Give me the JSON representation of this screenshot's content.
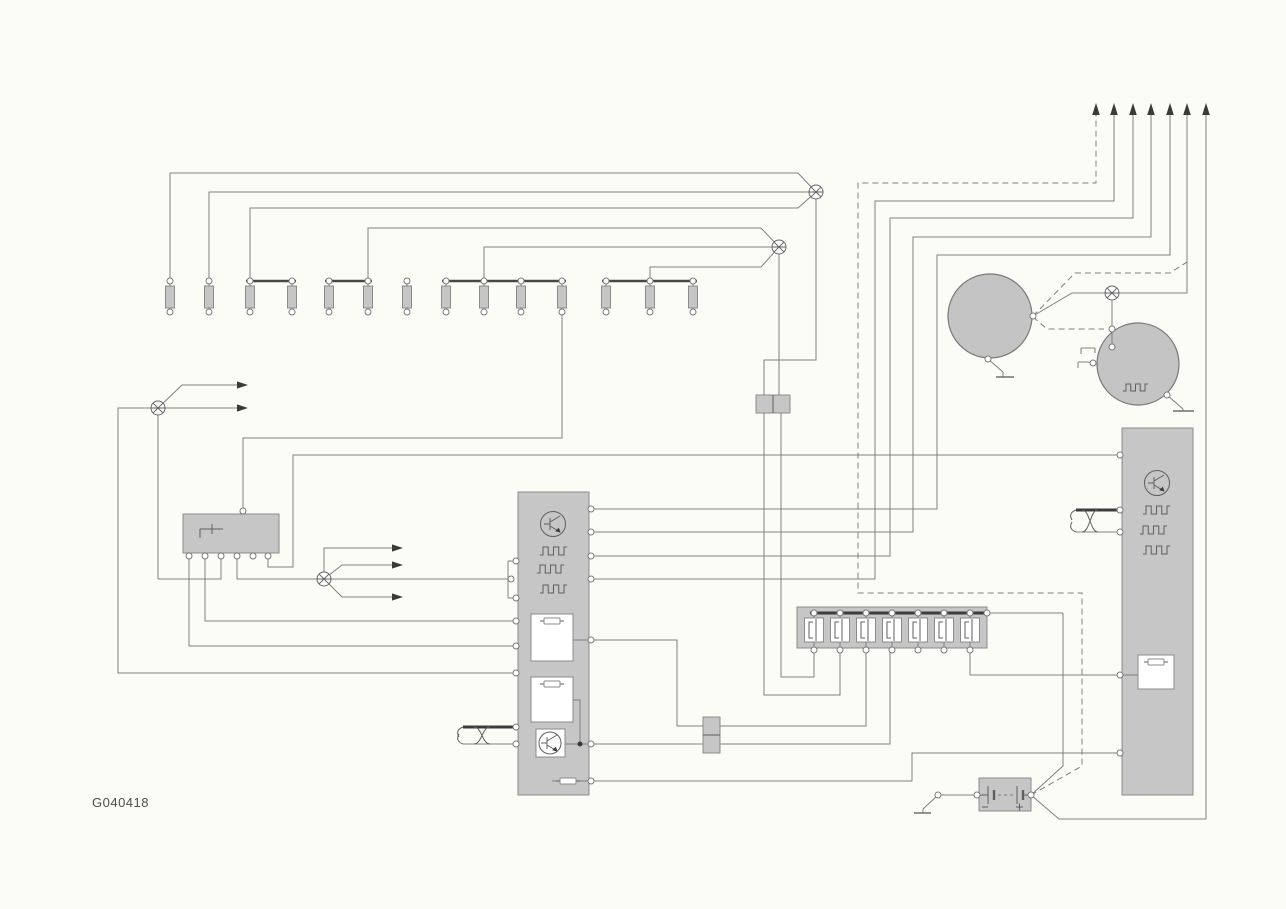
{
  "label": {
    "text": "G040418"
  },
  "canvas": {
    "w": 1286,
    "h": 909
  },
  "colors": {
    "background": "#fcfcf7",
    "wire": "#7f7f7f",
    "component_fill": "#c6c6c6",
    "component_stroke": "#8b8b8b",
    "dark": "#3c3c3c"
  },
  "boxes": [
    {
      "name": "control-unit-box",
      "x": 518,
      "y": 492,
      "w": 71,
      "h": 303
    },
    {
      "name": "relay-box",
      "x": 183,
      "y": 514,
      "w": 96,
      "h": 39
    },
    {
      "name": "right-module-box",
      "x": 1122,
      "y": 428,
      "w": 71,
      "h": 367
    },
    {
      "name": "fuse-strip-box",
      "x": 797,
      "y": 607,
      "w": 190,
      "h": 41
    },
    {
      "name": "connector-double-top",
      "x": 756,
      "y": 395,
      "w": 34,
      "h": 18
    },
    {
      "name": "connector-double-mid",
      "x": 703,
      "y": 717,
      "w": 17,
      "h": 36
    },
    {
      "name": "battery-box",
      "x": 979,
      "y": 778,
      "w": 52,
      "h": 33
    }
  ],
  "dividers": [
    [
      773,
      395,
      773,
      413
    ],
    [
      703,
      735,
      720,
      735
    ]
  ],
  "white_boxes": [
    {
      "name": "driver-box-1",
      "x": 531,
      "y": 614,
      "w": 42,
      "h": 47
    },
    {
      "name": "driver-box-2",
      "x": 531,
      "y": 677,
      "w": 42,
      "h": 45
    },
    {
      "name": "transistor-box",
      "x": 536,
      "y": 729,
      "w": 29,
      "h": 28
    },
    {
      "name": "module-driver-box",
      "x": 1138,
      "y": 655,
      "w": 36,
      "h": 34
    }
  ],
  "big_circles": [
    {
      "name": "generator-circle",
      "cx": 990,
      "cy": 316,
      "r": 42
    },
    {
      "name": "alternator-circle",
      "cx": 1138,
      "cy": 364,
      "r": 41
    }
  ],
  "injectors": {
    "xs": [
      170,
      209,
      250,
      292,
      329,
      368,
      407,
      446,
      484,
      521,
      562,
      606,
      650,
      693
    ],
    "top_y": 281,
    "bot_y": 312,
    "body_y": 286,
    "body_h": 22,
    "body_w": 9,
    "bars": [
      [
        246,
        281,
        296
      ],
      [
        325,
        281,
        372
      ],
      [
        442,
        281,
        566
      ],
      [
        602,
        281,
        697
      ]
    ]
  },
  "fuse_strip": {
    "centers": [
      814,
      840,
      866,
      892,
      918,
      944,
      970
    ],
    "box_y": 618,
    "box_h": 24,
    "top_y": 613,
    "bot_y": 650,
    "bus": [
      810,
      613,
      984
    ]
  },
  "wires_solid": [
    [
      [
        170,
        281
      ],
      [
        170,
        173
      ],
      [
        798,
        173
      ],
      [
        816,
        192
      ]
    ],
    [
      [
        209,
        281
      ],
      [
        209,
        192
      ],
      [
        816,
        192
      ]
    ],
    [
      [
        250,
        281
      ],
      [
        250,
        208
      ],
      [
        798,
        208
      ],
      [
        816,
        192
      ]
    ],
    [
      [
        368,
        281
      ],
      [
        368,
        228
      ],
      [
        761,
        228
      ],
      [
        779,
        247
      ]
    ],
    [
      [
        484,
        281
      ],
      [
        484,
        247
      ],
      [
        779,
        247
      ]
    ],
    [
      [
        650,
        281
      ],
      [
        650,
        267
      ],
      [
        761,
        267
      ],
      [
        779,
        247
      ]
    ],
    [
      [
        816,
        192
      ],
      [
        816,
        360
      ],
      [
        764,
        360
      ],
      [
        764,
        395
      ]
    ],
    [
      [
        779,
        247
      ],
      [
        779,
        395
      ]
    ],
    [
      [
        764,
        413
      ],
      [
        764,
        695
      ],
      [
        840,
        695
      ],
      [
        840,
        650
      ]
    ],
    [
      [
        781,
        413
      ],
      [
        781,
        677
      ],
      [
        814,
        677
      ],
      [
        814,
        650
      ]
    ],
    [
      [
        562,
        312
      ],
      [
        562,
        438
      ],
      [
        243,
        438
      ],
      [
        243,
        511
      ]
    ],
    [
      [
        268,
        556
      ],
      [
        268,
        567
      ],
      [
        293,
        567
      ],
      [
        293,
        455
      ],
      [
        1117,
        455
      ]
    ],
    [
      [
        237,
        556
      ],
      [
        237,
        579
      ],
      [
        508,
        579
      ]
    ],
    [
      [
        221,
        556
      ],
      [
        221,
        579
      ],
      [
        158,
        579
      ]
    ],
    [
      [
        158,
        408
      ],
      [
        158,
        579
      ]
    ],
    [
      [
        158,
        408
      ],
      [
        118,
        408
      ],
      [
        118,
        673
      ],
      [
        514,
        673
      ]
    ],
    [
      [
        189,
        556
      ],
      [
        189,
        646
      ],
      [
        514,
        646
      ]
    ],
    [
      [
        205,
        556
      ],
      [
        205,
        621
      ],
      [
        514,
        621
      ]
    ],
    [
      [
        158,
        408
      ],
      [
        182,
        385
      ],
      [
        242,
        385
      ]
    ],
    [
      [
        158,
        408
      ],
      [
        242,
        408
      ]
    ],
    [
      [
        324,
        579
      ],
      [
        324,
        548
      ],
      [
        397,
        548
      ]
    ],
    [
      [
        324,
        579
      ],
      [
        342,
        565
      ],
      [
        397,
        565
      ]
    ],
    [
      [
        324,
        579
      ],
      [
        342,
        597
      ],
      [
        397,
        597
      ]
    ],
    [
      [
        508,
        561
      ],
      [
        515,
        561
      ]
    ],
    [
      [
        508,
        598
      ],
      [
        515,
        598
      ]
    ],
    [
      [
        508,
        561
      ],
      [
        508,
        598
      ]
    ],
    [
      [
        592,
        509
      ],
      [
        937,
        509
      ],
      [
        937,
        255
      ],
      [
        1170,
        255
      ],
      [
        1170,
        114
      ]
    ],
    [
      [
        592,
        532
      ],
      [
        913,
        532
      ],
      [
        913,
        237
      ],
      [
        1151,
        237
      ],
      [
        1151,
        114
      ]
    ],
    [
      [
        592,
        556
      ],
      [
        890,
        556
      ],
      [
        890,
        218
      ],
      [
        1133,
        218
      ],
      [
        1133,
        114
      ]
    ],
    [
      [
        592,
        579
      ],
      [
        875,
        579
      ],
      [
        875,
        201
      ],
      [
        1114,
        201
      ],
      [
        1114,
        114
      ]
    ],
    [
      [
        573,
        640
      ],
      [
        591,
        640
      ]
    ],
    [
      [
        592,
        640
      ],
      [
        677,
        640
      ],
      [
        677,
        726
      ],
      [
        703,
        726
      ]
    ],
    [
      [
        720,
        726
      ],
      [
        866,
        726
      ],
      [
        866,
        650
      ]
    ],
    [
      [
        565,
        744
      ],
      [
        703,
        744
      ]
    ],
    [
      [
        573,
        700
      ],
      [
        580,
        700
      ],
      [
        580,
        744
      ]
    ],
    [
      [
        720,
        744
      ],
      [
        890,
        744
      ],
      [
        890,
        650
      ]
    ],
    [
      [
        552,
        781
      ],
      [
        592,
        781
      ]
    ],
    [
      [
        592,
        781
      ],
      [
        912,
        781
      ],
      [
        912,
        753
      ],
      [
        1117,
        753
      ]
    ],
    [
      [
        970,
        650
      ],
      [
        970,
        675
      ],
      [
        1117,
        675
      ]
    ],
    [
      [
        987,
        613
      ],
      [
        1063,
        613
      ]
    ],
    [
      [
        1031,
        795
      ],
      [
        1063,
        766
      ],
      [
        1063,
        613
      ]
    ],
    [
      [
        1031,
        795
      ],
      [
        1059,
        819
      ],
      [
        1206,
        819
      ],
      [
        1206,
        114
      ]
    ],
    [
      [
        977,
        795
      ],
      [
        941,
        795
      ]
    ],
    [
      [
        936,
        797
      ],
      [
        923,
        809
      ]
    ],
    [
      [
        923,
        809
      ],
      [
        923,
        813
      ]
    ],
    [
      [
        1033,
        316
      ],
      [
        1072,
        293
      ],
      [
        1187,
        293
      ],
      [
        1187,
        114
      ]
    ],
    [
      [
        1112,
        293
      ],
      [
        1112,
        347
      ]
    ],
    [
      [
        988,
        359
      ],
      [
        1003,
        372
      ]
    ],
    [
      [
        1003,
        372
      ],
      [
        1003,
        377
      ]
    ],
    [
      [
        1167,
        395
      ],
      [
        1183,
        409
      ]
    ],
    [
      [
        1183,
        409
      ],
      [
        1183,
        411
      ]
    ],
    [
      [
        1093,
        363
      ],
      [
        1088,
        362
      ]
    ],
    [
      [
        1081,
        348
      ],
      [
        1095,
        348
      ]
    ],
    [
      [
        1095,
        348
      ],
      [
        1095,
        353
      ]
    ],
    [
      [
        1081,
        348
      ],
      [
        1081,
        354
      ]
    ],
    [
      [
        1078,
        362
      ],
      [
        1088,
        362
      ]
    ],
    [
      [
        1078,
        362
      ],
      [
        1078,
        368
      ]
    ],
    [
      [
        1119,
        675
      ],
      [
        1138,
        675
      ]
    ],
    [
      [
        463,
        744
      ],
      [
        516,
        744
      ]
    ],
    [
      [
        1076,
        532
      ],
      [
        1117,
        532
      ]
    ],
    [
      [
        243,
        438
      ],
      [
        243,
        511
      ]
    ]
  ],
  "wires_dashed": [
    [
      [
        1031,
        795
      ],
      [
        1082,
        766
      ],
      [
        1082,
        593
      ],
      [
        858,
        593
      ],
      [
        858,
        183
      ],
      [
        1096,
        183
      ],
      [
        1096,
        114
      ]
    ],
    [
      [
        1033,
        316
      ],
      [
        1075,
        273
      ],
      [
        1170,
        273
      ],
      [
        1187,
        262
      ]
    ],
    [
      [
        1033,
        317
      ],
      [
        1047,
        329
      ],
      [
        1104,
        329
      ]
    ]
  ],
  "wires_thick": [
    [
      [
        463,
        727
      ],
      [
        516,
        727
      ]
    ],
    [
      [
        1076,
        510
      ],
      [
        1117,
        510
      ]
    ]
  ],
  "bus_bar": [
    810,
    613,
    984
  ],
  "twists": [
    "M474,727 C482,727 482,744 490,744",
    "M474,744 C482,744 482,727 490,727",
    "M1082,510 C1090,510 1090,532 1098,532",
    "M1082,532 C1090,532 1090,510 1098,510",
    "M463,727 q-8,3 -4,10",
    "M463,744 q-8,-3 -4,-10",
    "M1076,510 q-8,3 -4,10",
    "M1076,532 q-8,-3 -4,-10"
  ],
  "splices": [
    [
      816,
      192
    ],
    [
      779,
      247
    ],
    [
      158,
      408
    ],
    [
      324,
      579
    ],
    [
      1112,
      293
    ]
  ],
  "arrows_up": [
    1096,
    1114,
    1133,
    1151,
    1170,
    1187,
    1206
  ],
  "arrows_up_tip_y": 103,
  "arrows_right": [
    [
      248,
      385
    ],
    [
      248,
      408
    ],
    [
      403,
      548
    ],
    [
      403,
      565
    ],
    [
      403,
      597
    ]
  ],
  "terminals": [
    [
      516,
      561
    ],
    [
      511,
      579
    ],
    [
      516,
      598
    ],
    [
      516,
      621
    ],
    [
      516,
      646
    ],
    [
      516,
      673
    ],
    [
      516,
      727
    ],
    [
      516,
      744
    ],
    [
      591,
      509
    ],
    [
      591,
      532
    ],
    [
      591,
      556
    ],
    [
      591,
      579
    ],
    [
      591,
      640
    ],
    [
      591,
      744
    ],
    [
      591,
      781
    ],
    [
      243,
      511
    ],
    [
      189,
      556
    ],
    [
      205,
      556
    ],
    [
      221,
      556
    ],
    [
      237,
      556
    ],
    [
      253,
      556
    ],
    [
      268,
      556
    ],
    [
      987,
      613
    ],
    [
      1120,
      455
    ],
    [
      1120,
      510
    ],
    [
      1120,
      532
    ],
    [
      1120,
      675
    ],
    [
      1120,
      753
    ],
    [
      1033,
      316
    ],
    [
      988,
      359
    ],
    [
      1112,
      329
    ],
    [
      1112,
      347
    ],
    [
      1093,
      363
    ],
    [
      1167,
      395
    ],
    [
      977,
      795
    ],
    [
      1031,
      795
    ],
    [
      938,
      795
    ]
  ],
  "junction_dots": [
    [
      580,
      744
    ]
  ],
  "grounds": [
    [
      914,
      813,
      931,
      813
    ],
    [
      996,
      377,
      1014,
      377
    ],
    [
      1173,
      411,
      1194,
      411
    ]
  ],
  "transistors": [
    {
      "cx": 553,
      "cy": 524,
      "r": 12.5
    },
    {
      "cx": 550,
      "cy": 743,
      "r": 11
    },
    {
      "cx": 1157,
      "cy": 483,
      "r": 12.5
    }
  ],
  "squarewaves": [
    {
      "x": 540,
      "y": 547,
      "w": 27,
      "h": 8
    },
    {
      "x": 537,
      "y": 565,
      "w": 27,
      "h": 8
    },
    {
      "x": 540,
      "y": 585,
      "w": 27,
      "h": 8
    },
    {
      "x": 1143,
      "y": 506,
      "w": 27,
      "h": 8
    },
    {
      "x": 1140,
      "y": 526,
      "w": 27,
      "h": 8
    },
    {
      "x": 1143,
      "y": 546,
      "w": 27,
      "h": 8
    },
    {
      "x": 1123,
      "y": 384,
      "w": 25,
      "h": 7
    }
  ],
  "fuse_glyphs": [
    {
      "cx": 552,
      "cy": 621
    },
    {
      "cx": 552,
      "cy": 684
    },
    {
      "cx": 1156,
      "cy": 662
    },
    {
      "cx": 568,
      "cy": 781
    }
  ],
  "relay_glyph": [
    [
      200,
      538,
      200,
      529
    ],
    [
      200,
      529,
      223,
      529
    ],
    [
      212,
      524,
      212,
      534
    ]
  ],
  "battery_glyph": {
    "long_plates": [
      [
        988,
        786,
        988,
        804
      ],
      [
        1017,
        786,
        1017,
        804
      ]
    ],
    "short_plates": [
      [
        994,
        790,
        994,
        800
      ],
      [
        1023,
        790,
        1023,
        800
      ]
    ],
    "leads": [
      [
        979,
        795,
        988,
        795
      ],
      [
        1023,
        795,
        1031,
        795
      ]
    ],
    "mid_dash": [
      998,
      795,
      1013,
      795
    ],
    "minus": [
      [
        982,
        807,
        988,
        807
      ]
    ],
    "plus": [
      [
        1016,
        807,
        1023,
        807
      ],
      [
        1019.5,
        803.5,
        1019.5,
        810.5
      ]
    ]
  }
}
